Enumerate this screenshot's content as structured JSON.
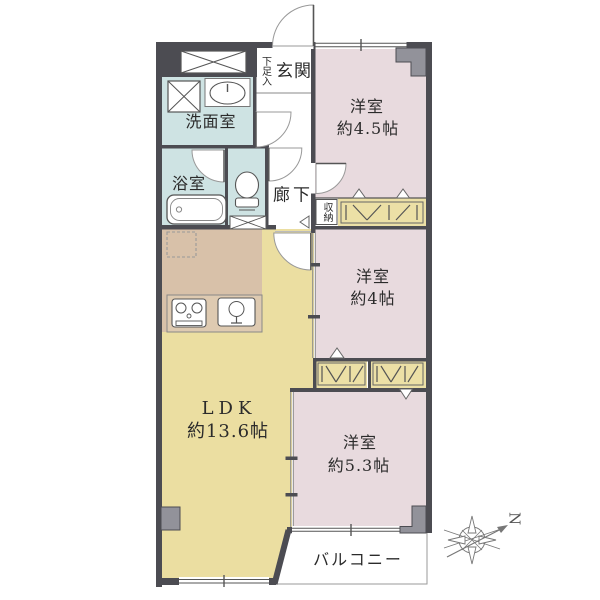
{
  "plan": {
    "entrance": {
      "label": "玄関"
    },
    "shoe_cabinet": {
      "label": "下足入"
    },
    "washroom": {
      "label": "洗面室"
    },
    "bathroom": {
      "label": "浴室"
    },
    "corridor": {
      "label": "廊下"
    },
    "storage": {
      "label": "収納"
    },
    "bedroom_a": {
      "label": "洋室",
      "size": "約4.5帖"
    },
    "bedroom_b": {
      "label": "洋室",
      "size": "約4帖"
    },
    "bedroom_c": {
      "label": "洋室",
      "size": "約5.3帖"
    },
    "ldk": {
      "label": "LDK",
      "size": "約13.6帖"
    },
    "balcony": {
      "label": "バルコニー"
    },
    "compass": {
      "north_label": "N"
    }
  },
  "colors": {
    "wall": "#4c4c52",
    "pillar": "#92929a",
    "room_pink": "#e8dade",
    "ldk_yellow": "#ebdea1",
    "closet_yellow": "#ece0a6",
    "kitchen_tan": "#d8c1a9",
    "wet_area_blue": "#cee3e3",
    "balcony_white": "#ffffff",
    "text": "#2b2b2b"
  },
  "fixtures": [
    "meter-box-icon",
    "washing-machine-icon",
    "vanity-sink-icon",
    "bathtub-icon",
    "toilet-icon",
    "refrigerator-icon",
    "stove-icon",
    "kitchen-sink-icon",
    "closet-hatch-icon",
    "compass-icon"
  ]
}
